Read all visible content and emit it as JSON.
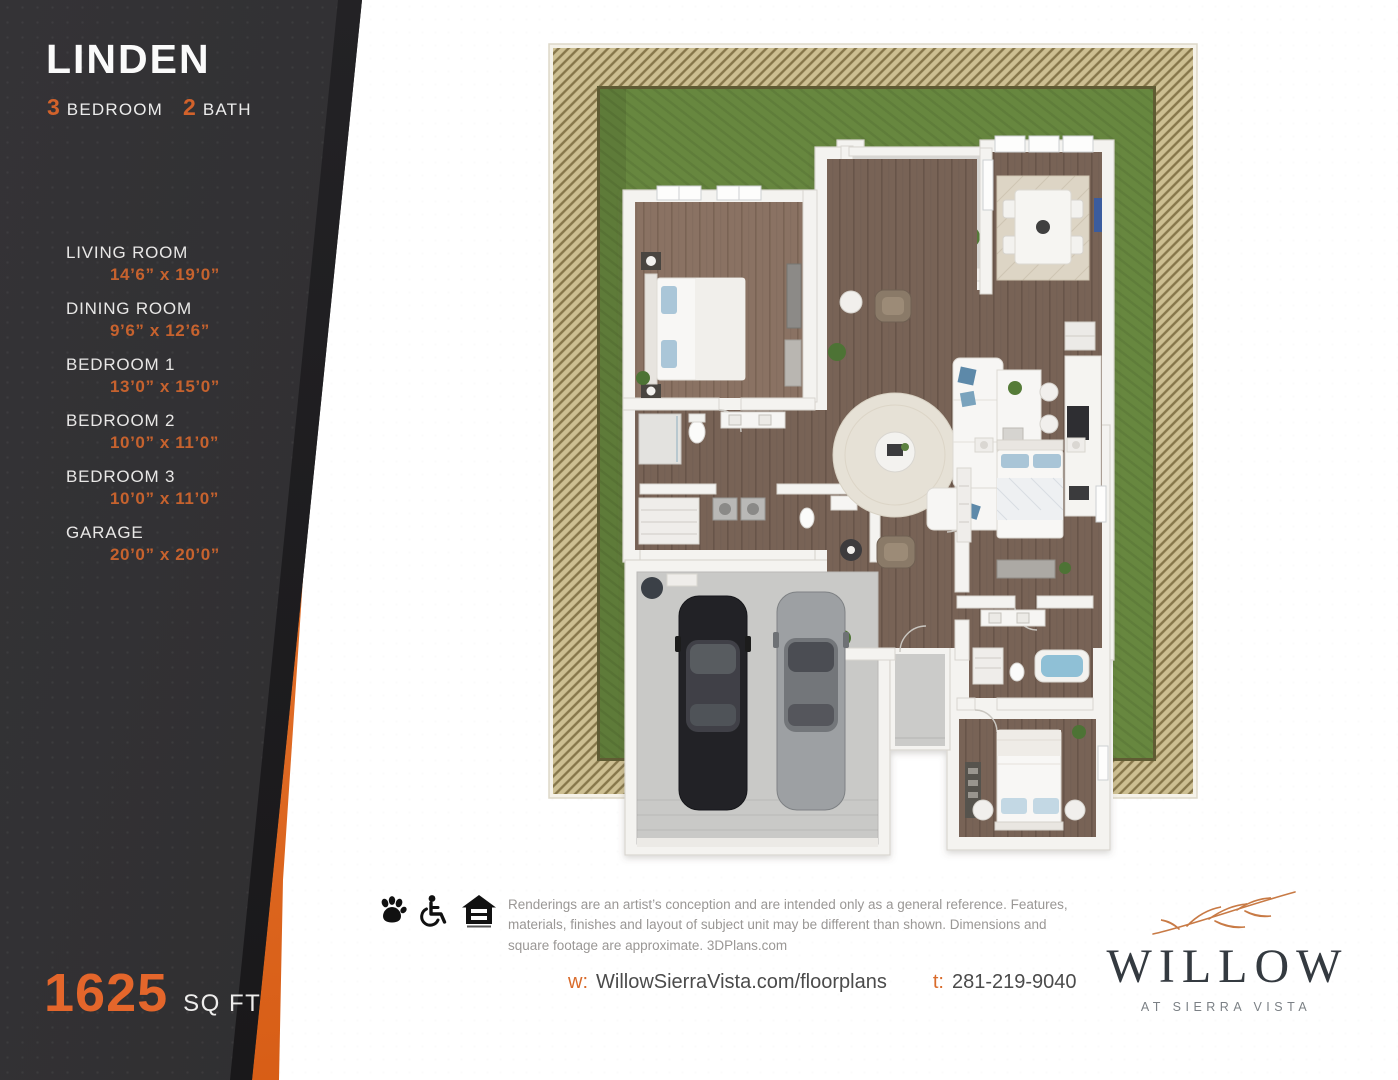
{
  "sidebar": {
    "plan_name": "LINDEN",
    "bed_count": "3",
    "bed_label": "BEDROOM",
    "bath_count": "2",
    "bath_label": "BATH",
    "rooms": [
      {
        "name": "LIVING ROOM",
        "dims": "14’6” x 19’0”"
      },
      {
        "name": "DINING ROOM",
        "dims": "9’6” x 12’6”"
      },
      {
        "name": "BEDROOM 1",
        "dims": "13’0” x 15’0”"
      },
      {
        "name": "BEDROOM 2",
        "dims": "10’0” x 11’0”"
      },
      {
        "name": "BEDROOM 3",
        "dims": "10’0” x 11’0”"
      },
      {
        "name": "GARAGE",
        "dims": "20’0” x 20’0”"
      }
    ],
    "sqft_value": "1625",
    "sqft_label": "SQ FT"
  },
  "footer": {
    "icons": [
      "paw-icon",
      "wheelchair-accessible-icon",
      "equal-housing-icon"
    ],
    "disclaimer": "Renderings are an artist’s conception and are intended only as a general reference. Features, materials, finishes and layout of subject unit may be different than shown. Dimensions and square footage are approximate. 3DPlans.com",
    "web_prefix": "w:",
    "website": "WillowSierraVista.com/floorplans",
    "tel_prefix": "t:",
    "phone": "281-219-9040"
  },
  "brand": {
    "name": "WILLOW",
    "tagline": "AT SIERRA VISTA"
  },
  "colors": {
    "accent_orange": "#e06f2c",
    "dimension_orange": "#c6622e",
    "sidebar_dark": "#2e2d2f",
    "yard_green": "#67873f",
    "fence_tan": "#cdbf92",
    "logo_text": "#343a40"
  }
}
